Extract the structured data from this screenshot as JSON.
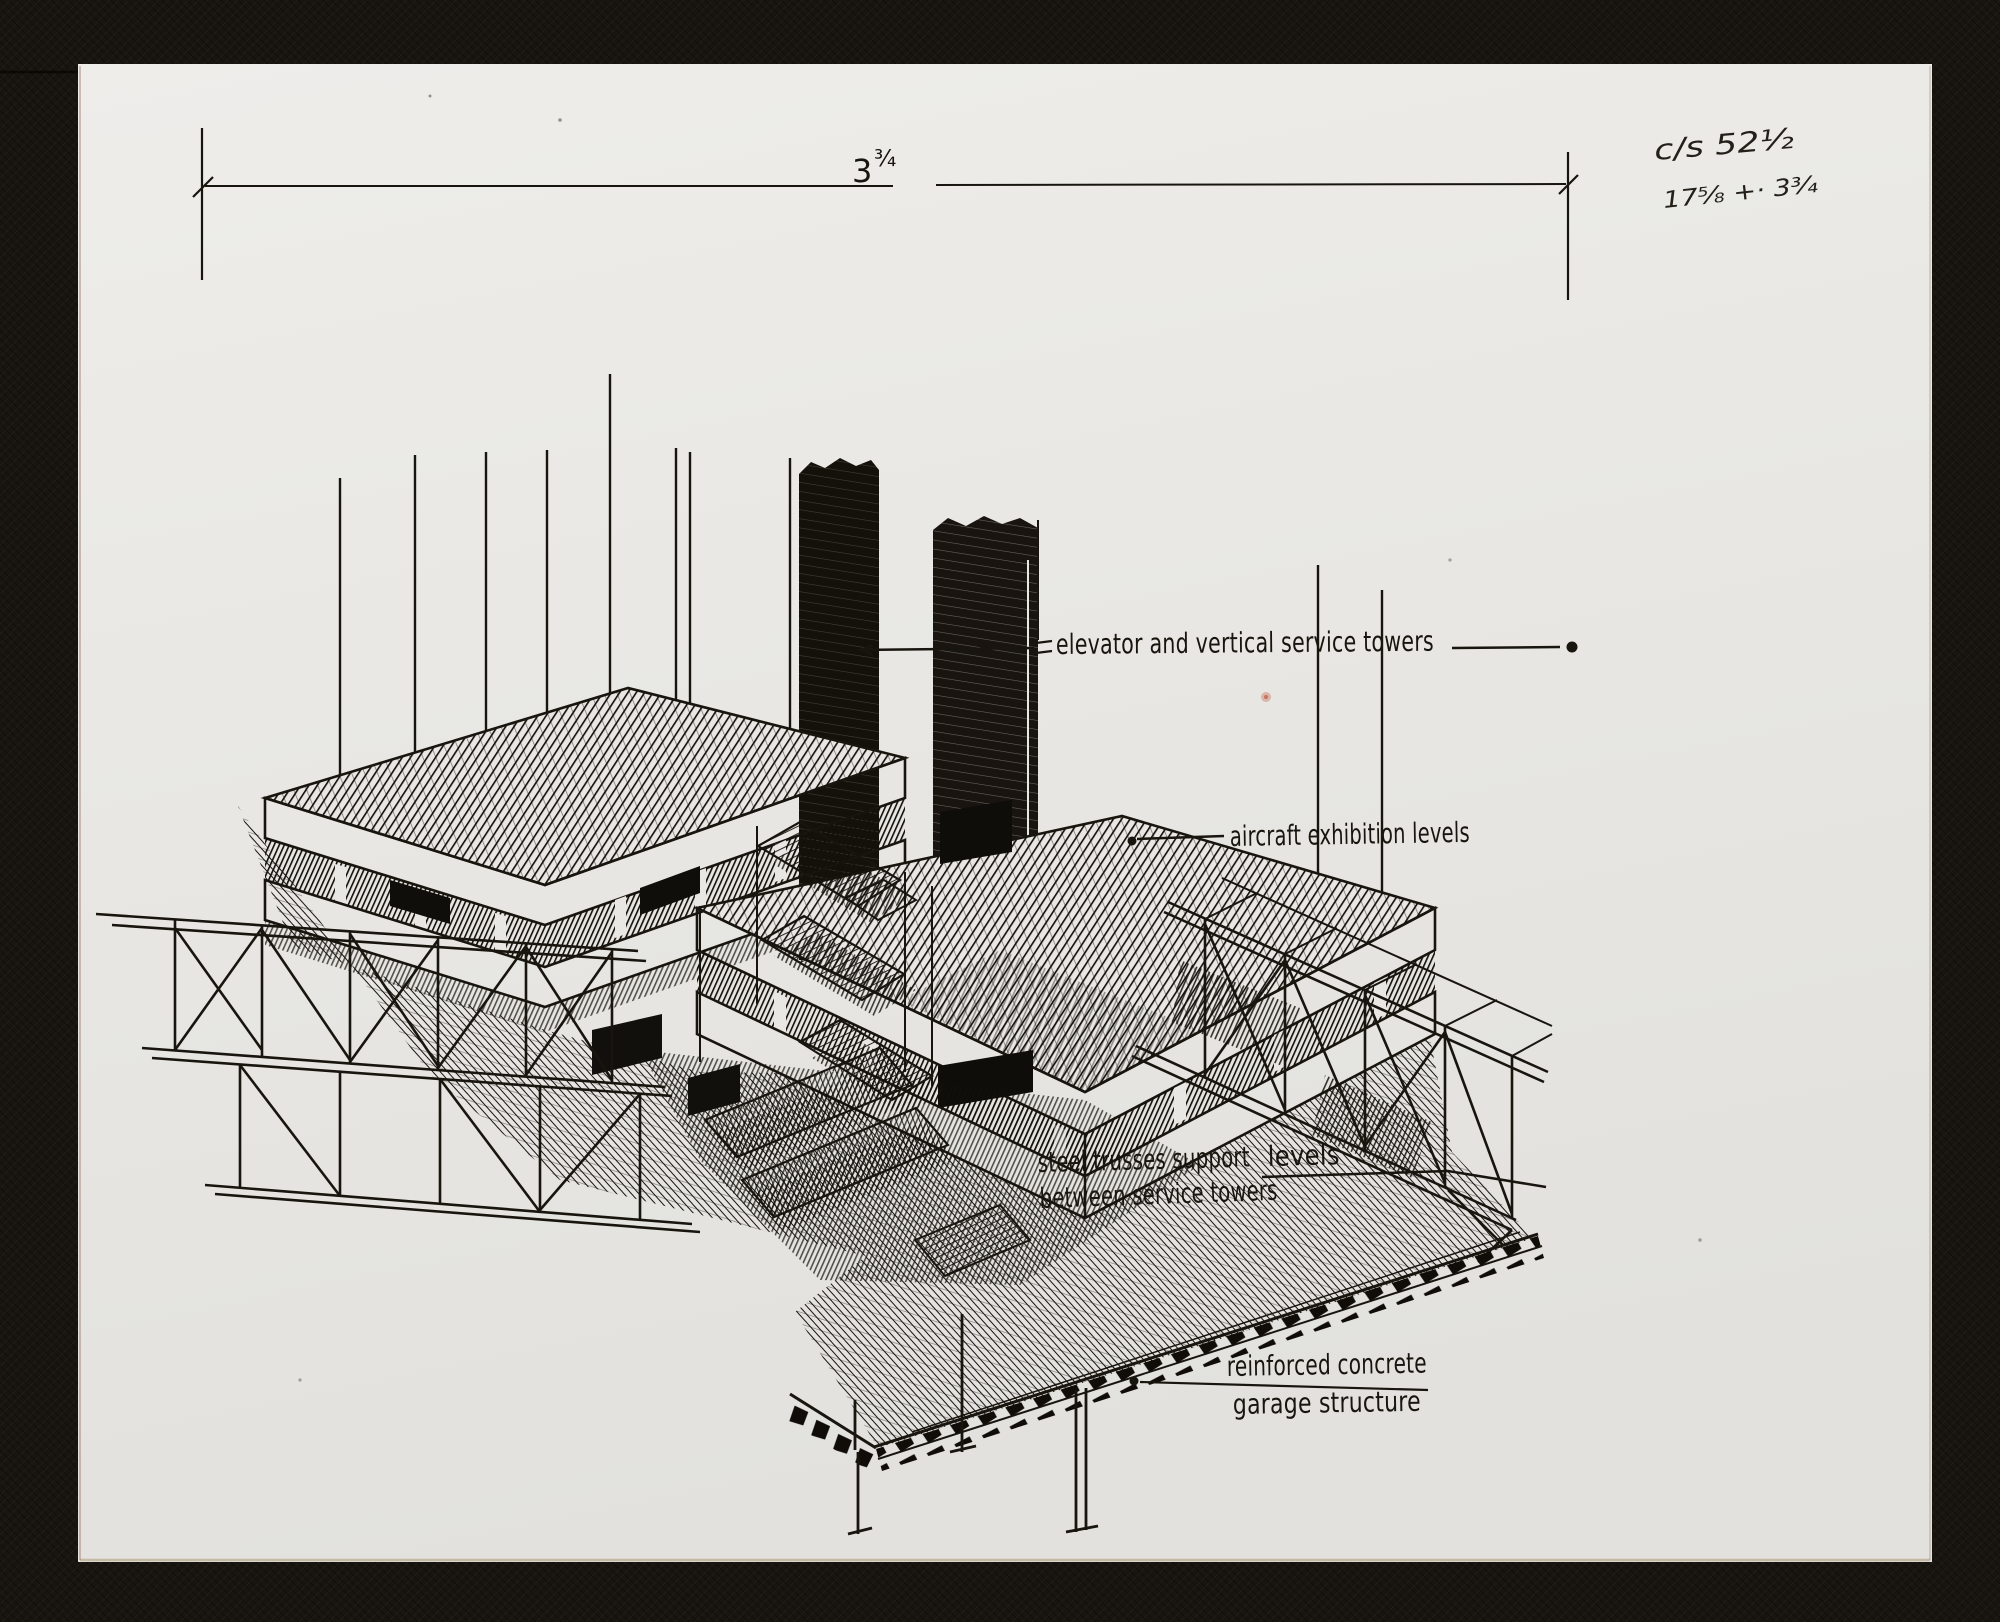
{
  "artwork": {
    "dimension_note": {
      "whole": "3",
      "fraction": "¾"
    },
    "corner_notes": {
      "line1": "c/s 52½",
      "line2": "17⅝ +· 3¾"
    },
    "labels": {
      "elevator": "elevator and vertical service towers",
      "aircraft": "aircraft exhibition levels",
      "trusses_part1": "steel trusses support",
      "trusses_levels": "levels",
      "trusses_line2": "between service towers",
      "garage_line1": "reinforced concrete",
      "garage_line2": "garage structure"
    },
    "colors": {
      "paper": "#e9e8e4",
      "mat": "#18140f",
      "ink": "#18140e"
    }
  }
}
